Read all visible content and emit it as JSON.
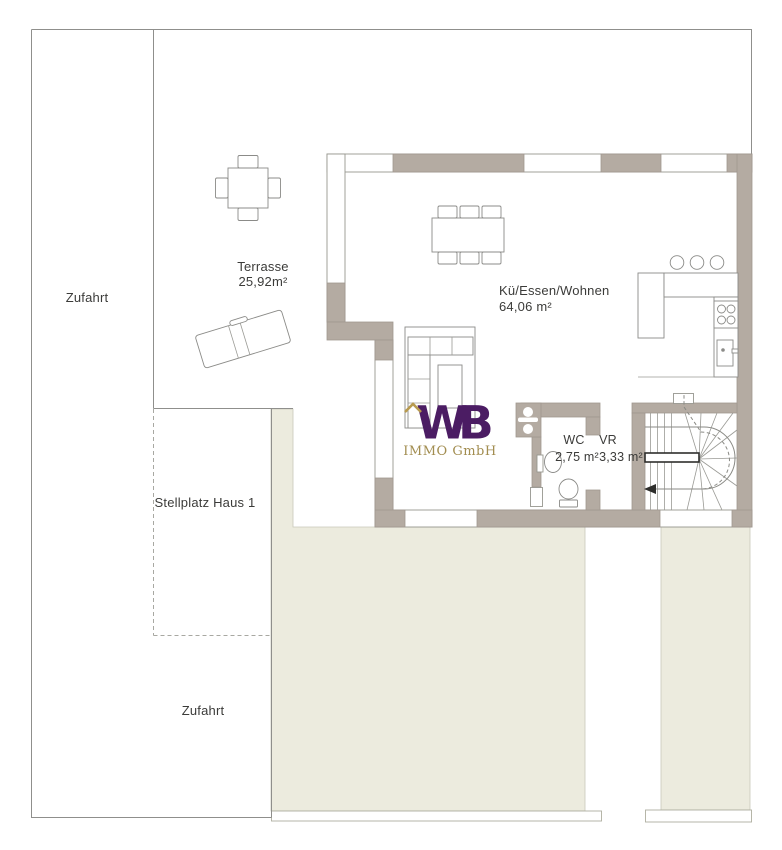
{
  "document": {
    "type": "floor-plan",
    "title": "Erdgeschoss / Grundriss Haus 1"
  },
  "areas": {
    "zufahrt_left": "Zufahrt",
    "terrasse": {
      "name": "Terrasse",
      "size": "25,92m²"
    },
    "living": {
      "name": "Kü/Essen/Wohnen",
      "size": "64,06 m²"
    },
    "wc": {
      "name": "WC",
      "size": "2,75 m²"
    },
    "vr": {
      "name": "VR",
      "size": "3,33 m²"
    },
    "stellplatz": "Stellplatz Haus 1",
    "zufahrt_bottom": "Zufahrt"
  },
  "logo": {
    "monogram": "WB",
    "company": "IMMO GmbH"
  },
  "colors": {
    "wall": "#b4aba2",
    "driveway_fill": "#ecebde",
    "boundary_line": "#8f8f8c",
    "text": "#3b3b39",
    "logo_purple": "#4b1c63",
    "logo_gold": "#a28d50"
  }
}
